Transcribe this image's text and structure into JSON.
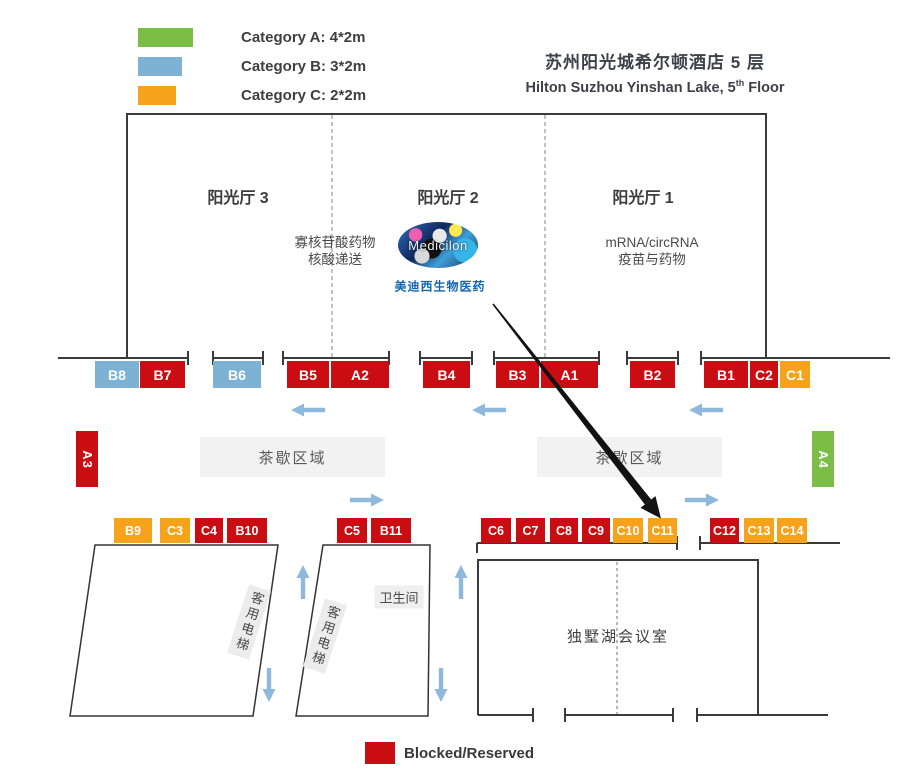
{
  "colors": {
    "cat_a": "#7CBE45",
    "cat_b": "#7EB2D4",
    "cat_c": "#F7A21B",
    "blocked": "#C90D12",
    "arrow_blue": "#8FB9DC",
    "wall": "#3A3A3A"
  },
  "legend_top": [
    {
      "label": "Category A: 4*2m",
      "cat": "cat_a",
      "w": 55,
      "y": 28
    },
    {
      "label": "Category B: 3*2m",
      "cat": "cat_b",
      "w": 44,
      "y": 57
    },
    {
      "label": "Category C: 2*2m",
      "cat": "cat_c",
      "w": 38,
      "y": 86
    }
  ],
  "legend_bottom": {
    "label": "Blocked/Reserved",
    "cat": "blocked"
  },
  "header": {
    "title_cn": "苏州阳光城希尔顿酒店 5 层",
    "title_en_pre": "Hilton Suzhou Yinshan Lake, 5",
    "title_en_sup": "th",
    "title_en_post": " Floor"
  },
  "halls": [
    {
      "name": "阳光厅 3",
      "cx": 238,
      "cy": 196
    },
    {
      "name": "阳光厅 2",
      "cx": 448,
      "cy": 196
    },
    {
      "name": "阳光厅 1",
      "cx": 643,
      "cy": 196
    }
  ],
  "annotations": [
    {
      "lines": [
        "寡核苷酸药物",
        "核酸递送"
      ],
      "cx": 335,
      "cy": 252
    },
    {
      "lines": [
        "mRNA/circRNA",
        "疫苗与药物"
      ],
      "cx": 652,
      "cy": 252
    }
  ],
  "logo": {
    "text": "Medicilon",
    "caption": "美迪西生物医药"
  },
  "booths": [
    {
      "id": "B8",
      "cat": "cat_b",
      "x": 95,
      "y": 361,
      "w": 44,
      "h": 27
    },
    {
      "id": "B7",
      "cat": "blocked",
      "x": 140,
      "y": 361,
      "w": 45,
      "h": 27
    },
    {
      "id": "B6",
      "cat": "cat_b",
      "x": 213,
      "y": 361,
      "w": 48,
      "h": 27
    },
    {
      "id": "B5",
      "cat": "blocked",
      "x": 287,
      "y": 361,
      "w": 42,
      "h": 27
    },
    {
      "id": "A2",
      "cat": "blocked",
      "x": 331,
      "y": 361,
      "w": 58,
      "h": 27
    },
    {
      "id": "B4",
      "cat": "blocked",
      "x": 423,
      "y": 361,
      "w": 47,
      "h": 27
    },
    {
      "id": "B3",
      "cat": "blocked",
      "x": 496,
      "y": 361,
      "w": 43,
      "h": 27
    },
    {
      "id": "A1",
      "cat": "blocked",
      "x": 541,
      "y": 361,
      "w": 57,
      "h": 27
    },
    {
      "id": "B2",
      "cat": "blocked",
      "x": 630,
      "y": 361,
      "w": 45,
      "h": 27
    },
    {
      "id": "B1",
      "cat": "blocked",
      "x": 704,
      "y": 361,
      "w": 44,
      "h": 27
    },
    {
      "id": "C2",
      "cat": "blocked",
      "x": 750,
      "y": 361,
      "w": 28,
      "h": 27
    },
    {
      "id": "C1",
      "cat": "cat_c",
      "x": 780,
      "y": 361,
      "w": 30,
      "h": 27
    },
    {
      "id": "A3",
      "cat": "blocked",
      "x": 76,
      "y": 431,
      "w": 22,
      "h": 56,
      "vertical": true
    },
    {
      "id": "A4",
      "cat": "cat_a",
      "x": 812,
      "y": 431,
      "w": 22,
      "h": 56,
      "vertical": true
    },
    {
      "id": "B9",
      "cat": "cat_c",
      "x": 114,
      "y": 518,
      "w": 38,
      "h": 25,
      "small": true
    },
    {
      "id": "C3",
      "cat": "cat_c",
      "x": 160,
      "y": 518,
      "w": 30,
      "h": 25,
      "small": true
    },
    {
      "id": "C4",
      "cat": "blocked",
      "x": 195,
      "y": 518,
      "w": 28,
      "h": 25,
      "small": true
    },
    {
      "id": "B10",
      "cat": "blocked",
      "x": 227,
      "y": 518,
      "w": 40,
      "h": 25,
      "small": true
    },
    {
      "id": "C5",
      "cat": "blocked",
      "x": 337,
      "y": 518,
      "w": 30,
      "h": 25,
      "small": true
    },
    {
      "id": "B11",
      "cat": "blocked",
      "x": 371,
      "y": 518,
      "w": 40,
      "h": 25,
      "small": true
    },
    {
      "id": "C6",
      "cat": "blocked",
      "x": 481,
      "y": 518,
      "w": 30,
      "h": 25,
      "small": true
    },
    {
      "id": "C7",
      "cat": "blocked",
      "x": 516,
      "y": 518,
      "w": 29,
      "h": 25,
      "small": true
    },
    {
      "id": "C8",
      "cat": "blocked",
      "x": 550,
      "y": 518,
      "w": 28,
      "h": 25,
      "small": true
    },
    {
      "id": "C9",
      "cat": "blocked",
      "x": 582,
      "y": 518,
      "w": 28,
      "h": 25,
      "small": true
    },
    {
      "id": "C10",
      "cat": "cat_c",
      "x": 613,
      "y": 518,
      "w": 30,
      "h": 25,
      "small": true
    },
    {
      "id": "C11",
      "cat": "cat_c",
      "x": 648,
      "y": 518,
      "w": 29,
      "h": 25,
      "small": true
    },
    {
      "id": "C12",
      "cat": "blocked",
      "x": 710,
      "y": 518,
      "w": 29,
      "h": 25,
      "small": true
    },
    {
      "id": "C13",
      "cat": "cat_c",
      "x": 744,
      "y": 518,
      "w": 30,
      "h": 25,
      "small": true
    },
    {
      "id": "C14",
      "cat": "cat_c",
      "x": 777,
      "y": 518,
      "w": 30,
      "h": 25,
      "small": true
    }
  ],
  "areas": [
    {
      "type": "tea",
      "label": "茶歇区域",
      "x": 200,
      "y": 437,
      "w": 185,
      "h": 40
    },
    {
      "type": "tea",
      "label": "茶歇区域",
      "x": 537,
      "y": 437,
      "w": 185,
      "h": 40
    },
    {
      "type": "elevator",
      "label": "客用电梯",
      "cx": 249,
      "cy": 622
    },
    {
      "type": "elevator",
      "label": "客用电梯",
      "cx": 325,
      "cy": 636
    },
    {
      "type": "restroom",
      "label": "卫生间",
      "cx": 399,
      "cy": 597
    },
    {
      "type": "room-label",
      "label": "独墅湖会议室",
      "cx": 618,
      "cy": 636
    }
  ],
  "arrows_blue": [
    {
      "dir": "left",
      "cx": 308,
      "cy": 410
    },
    {
      "dir": "left",
      "cx": 489,
      "cy": 410
    },
    {
      "dir": "left",
      "cx": 706,
      "cy": 410
    },
    {
      "dir": "right",
      "cx": 367,
      "cy": 500
    },
    {
      "dir": "right",
      "cx": 702,
      "cy": 500
    },
    {
      "dir": "up",
      "cx": 303,
      "cy": 582
    },
    {
      "dir": "up",
      "cx": 461,
      "cy": 582
    },
    {
      "dir": "down",
      "cx": 269,
      "cy": 685
    },
    {
      "dir": "down",
      "cx": 441,
      "cy": 685
    }
  ],
  "black_arrow": {
    "from": [
      493,
      304
    ],
    "to": [
      648,
      502
    ]
  }
}
